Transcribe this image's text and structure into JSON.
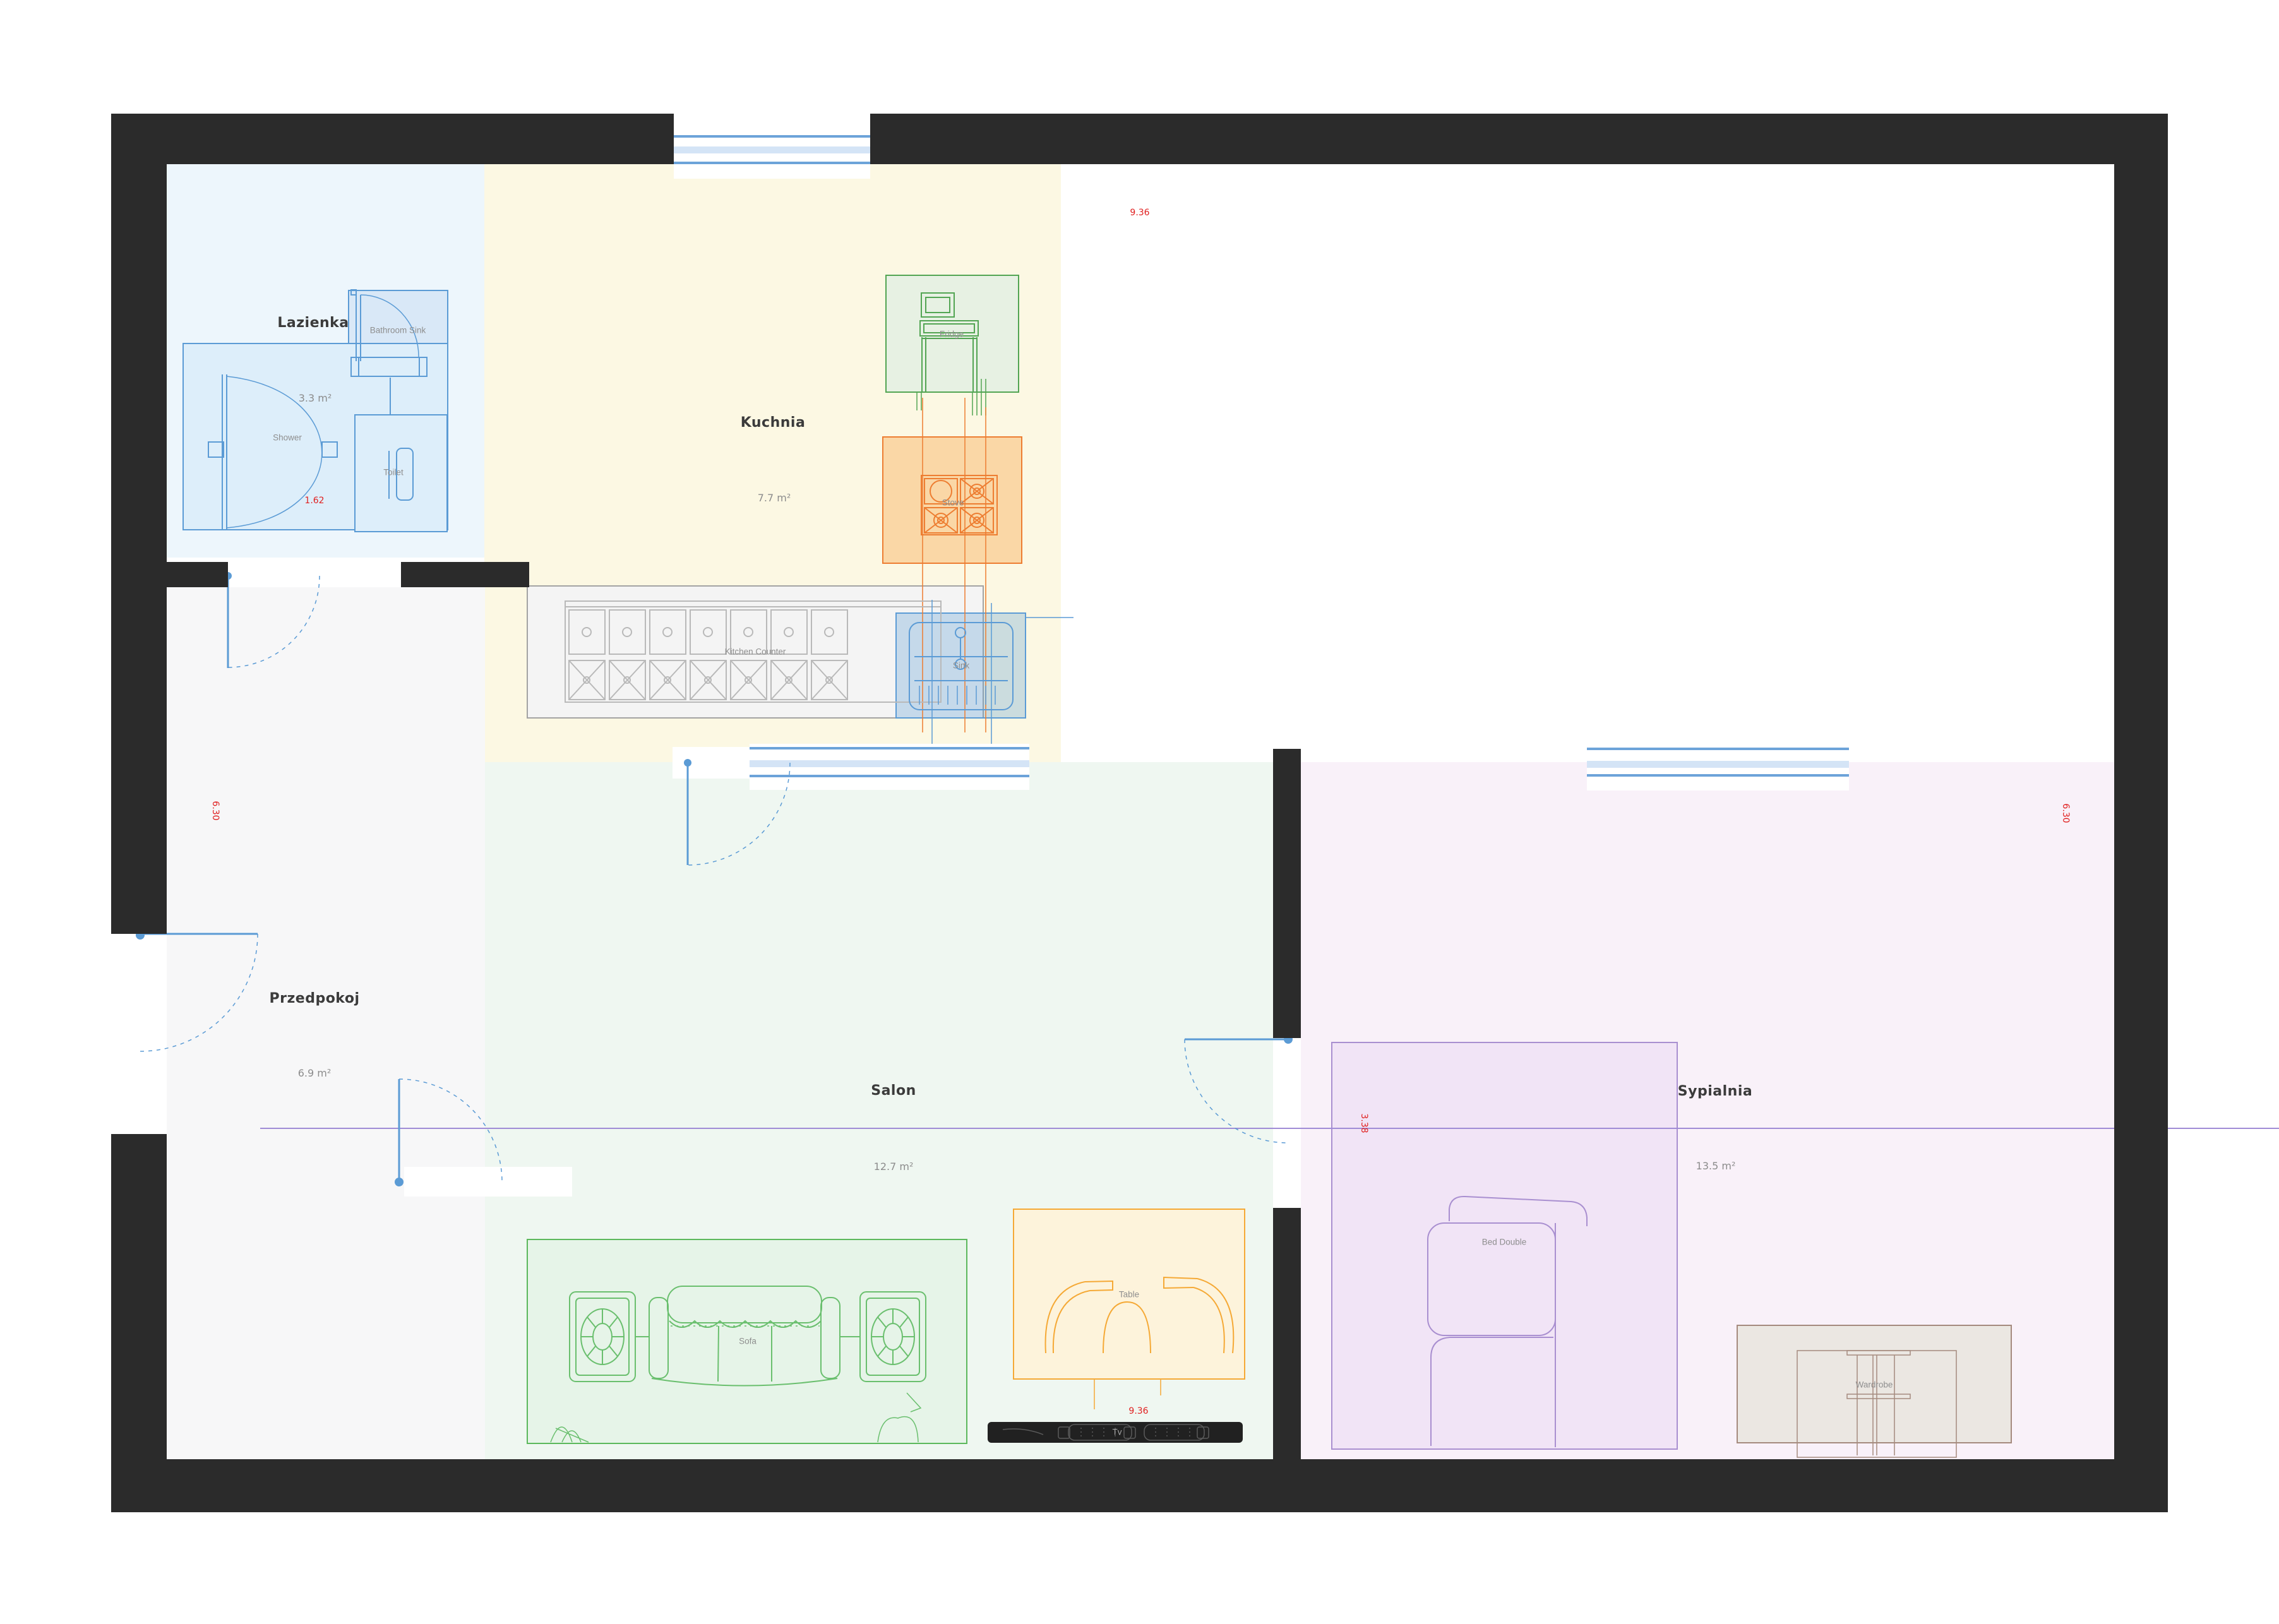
{
  "plan": {
    "rooms": {
      "lazienka": {
        "label": "Lazienka",
        "area": "3.3 m²",
        "color": "#edf6fc"
      },
      "kuchnia": {
        "label": "Kuchnia",
        "area": "7.7 m²",
        "color": "#fcf8e3"
      },
      "przedpokoj": {
        "label": "Przedpokoj",
        "area": "6.9 m²",
        "color": "#f7f7f8"
      },
      "salon": {
        "label": "Salon",
        "area": "12.7 m²",
        "color": "#eff7f1"
      },
      "sypialnia": {
        "label": "Sypialnia",
        "area": "13.5 m²",
        "color": "#f9f1f9"
      }
    },
    "furniture": {
      "bathroom_sink": {
        "label": "Bathroom Sink"
      },
      "shower": {
        "label": "Shower"
      },
      "toilet": {
        "label": "Toilet"
      },
      "fridge": {
        "label": "Fridge"
      },
      "stove": {
        "label": "Stove"
      },
      "kitchen_counter": {
        "label": "Kitchen Counter"
      },
      "sink": {
        "label": "Sink"
      },
      "sofa": {
        "label": "Sofa"
      },
      "table": {
        "label": "Table"
      },
      "tv": {
        "label": "Tv"
      },
      "bed": {
        "label": "Bed Double"
      },
      "wardrobe": {
        "label": "Wardrobe"
      }
    },
    "dimensions": {
      "top_width": "9.36",
      "bottom_width": "9.36",
      "left_height": "6.30",
      "right_height": "6.30",
      "bathroom_door": "1.62",
      "bed_width": "3.38"
    },
    "colors": {
      "wall": "#2b2b2b",
      "accent_blue": "#5b9bd5",
      "accent_green": "#53a553",
      "accent_orange": "#ed7d31",
      "accent_purple": "#a98fd0",
      "dim_red": "#e02020"
    }
  }
}
